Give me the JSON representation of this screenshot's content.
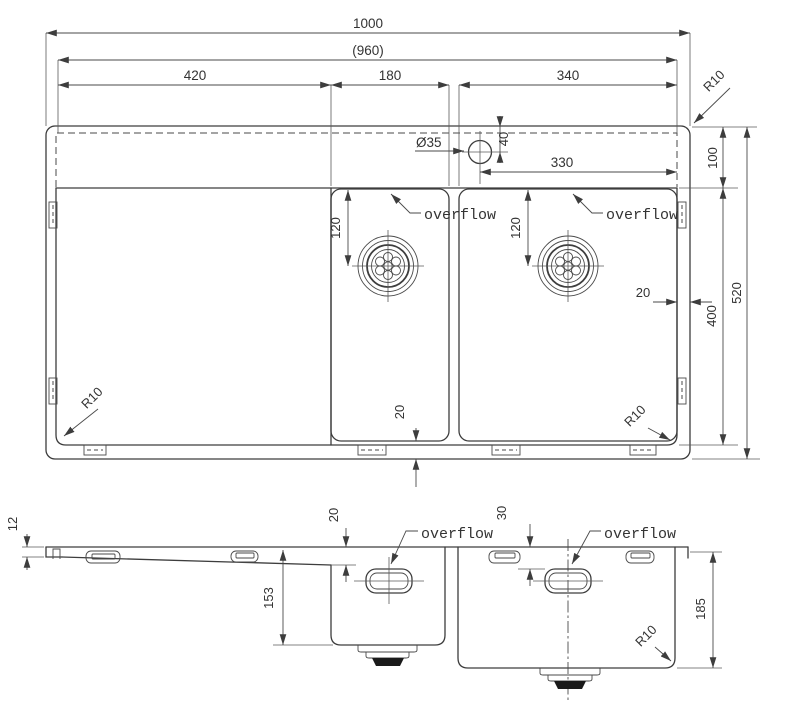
{
  "drawing": {
    "type": "technical-drawing-kitchen-sink",
    "line_color": "#3d3d3d",
    "text_color": "#333333",
    "background": "#ffffff",
    "top_view": {
      "dims": {
        "overall_width": "1000",
        "cutout_width": "(960)",
        "drainboard_width": "420",
        "middle_bowl_width": "180",
        "right_bowl_width": "340",
        "faucet_hole_diameter": "Ø35",
        "faucet_hole_offset_top": "40",
        "faucet_hole_to_right_edge": "330",
        "ledge_depth": "100",
        "overall_depth": "520",
        "bowl_area_depth": "400",
        "right_rim_gap": "20",
        "bottom_rim_gap": "20",
        "drain_offset_middle": "120",
        "drain_offset_right": "120",
        "radius_top_right": "R10",
        "radius_bottom_left": "R10",
        "radius_bottom_right": "R10"
      },
      "labels": {
        "overflow_middle": "overflow",
        "overflow_right": "overflow"
      }
    },
    "section_view": {
      "dims": {
        "rim_thickness": "12",
        "middle_overflow_drop": "20",
        "right_overflow_drop": "30",
        "middle_bowl_depth": "153",
        "right_bowl_depth": "185",
        "bowl_corner_radius": "R10"
      },
      "labels": {
        "overflow_middle": "overflow",
        "overflow_right": "overflow"
      }
    }
  }
}
